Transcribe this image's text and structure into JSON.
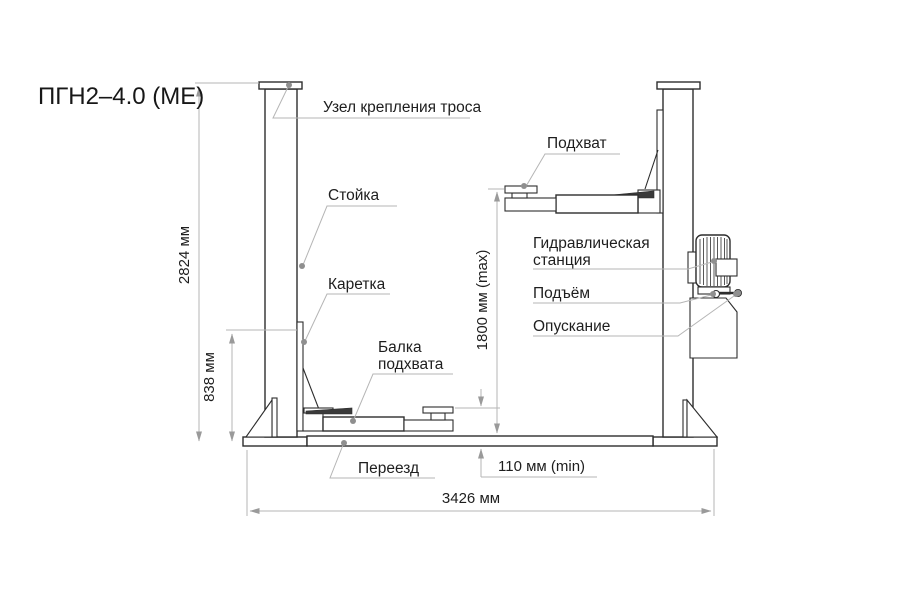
{
  "title": "ПГН2–4.0 (ME)",
  "labels": {
    "cable_unit": "Узел крепления троса",
    "post": "Стойка",
    "carriage": "Каретка",
    "beam_line1": "Балка",
    "beam_line2": "подхвата",
    "driveover": "Переезд",
    "pickup": "Подхват",
    "hydraulic_line1": "Гидравлическая",
    "hydraulic_line2": "станция",
    "lift": "Подъём",
    "lowering": "Опускание"
  },
  "dimensions": {
    "total_height": "2824 мм",
    "carriage_height": "838 мм",
    "lift_height_max": "1800 мм (max)",
    "pad_height_min": "110 мм (min)",
    "total_width": "3426 мм"
  },
  "colors": {
    "background": "#ffffff",
    "part_stroke": "#2d2d2d",
    "annotation_line": "#b5b5b5",
    "leader_dot": "#8f8f8f",
    "text": "#1e1e1e"
  }
}
